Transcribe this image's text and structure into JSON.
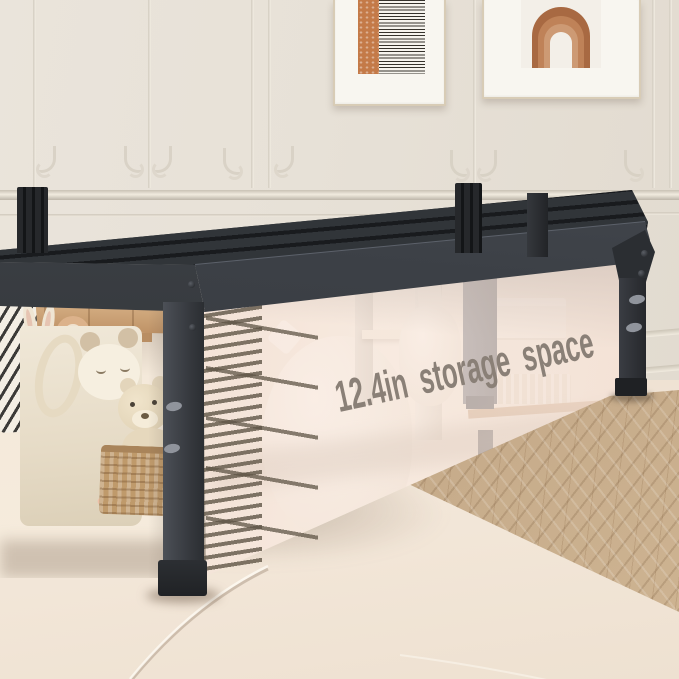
{
  "annotation": {
    "storage_label": "12.4in storage space"
  },
  "colors": {
    "bed_frame": "#2e3135",
    "overlay_panel": "#f6e6dc",
    "annotation_text": "#8a8077",
    "ruler_lines": "#5f5546",
    "wall": "#e7e1d7",
    "rug": "#f0e4d5",
    "wood_floor": "#c4a886",
    "art_accent": "#b9764b"
  }
}
